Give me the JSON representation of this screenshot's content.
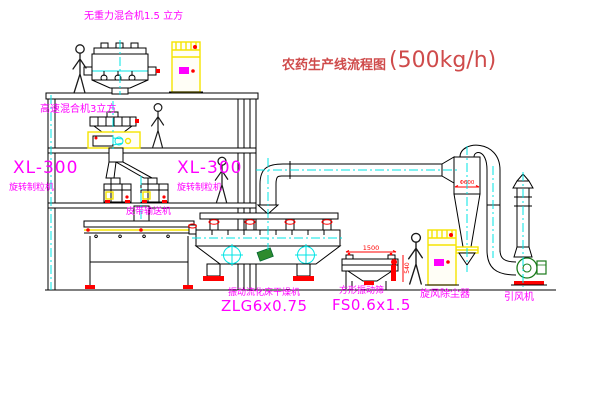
{
  "title": {
    "main": "农药生产线流程图",
    "capacity": "(500kg/h)"
  },
  "labels": {
    "gravity_mixer": "无重力混合机1.5 立方",
    "high_speed_mixer": "高速混合机3立方",
    "granulator_left_model": "XL-300",
    "granulator_left_name": "旋转制粒机",
    "granulator_center_model": "XL-300",
    "granulator_center_name": "旋转制粒机",
    "belt_conveyor": "皮带输送机",
    "dryer_name": "振动流化床干燥机",
    "dryer_model": "ZLG6x0.75",
    "sieve_name": "方形振动筛",
    "sieve_model": "FS0.6x1.5",
    "cyclone": "旋风除尘器",
    "fan": "引风机"
  },
  "dimensions": {
    "sieve_width": "1500",
    "sieve_height": "540",
    "cyclone_diameter": "Φ600"
  },
  "colors": {
    "label_magenta": "#ff00ff",
    "title_red": "#cf4b4b",
    "dimension_red": "#ff0000",
    "equipment_yellow": "#f5e400",
    "centerline_cyan": "#00e5e5",
    "fan_green": "#1a7a1a",
    "line_black": "#000000"
  }
}
